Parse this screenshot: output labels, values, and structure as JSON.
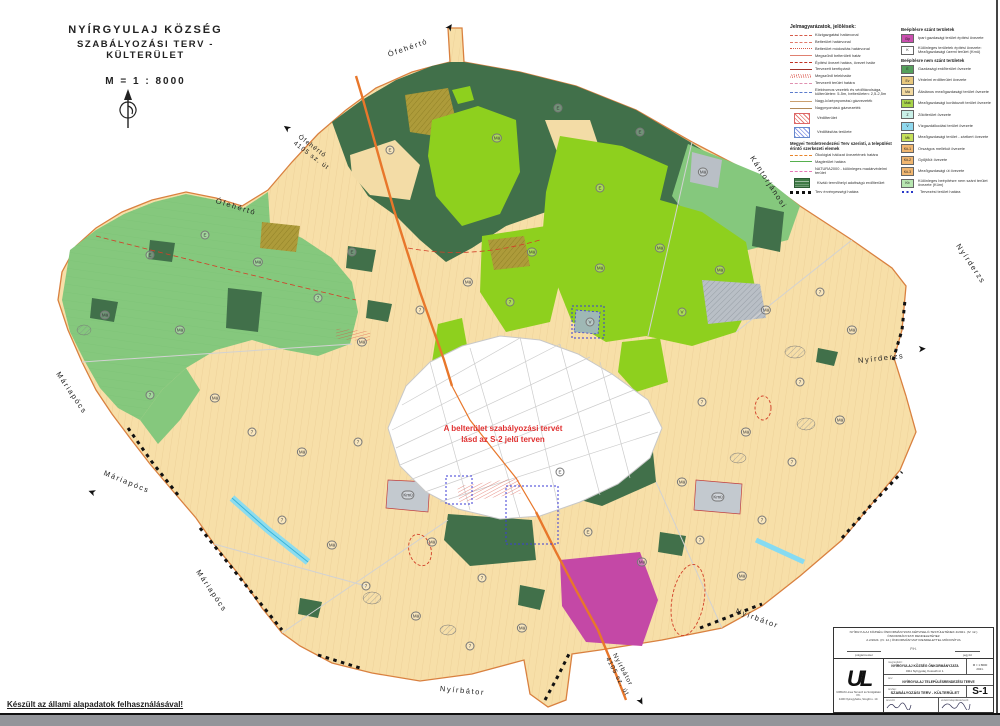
{
  "page": {
    "title_line1": "NYÍRGYULAJ KÖZSÉG",
    "title_line2": "SZABÁLYOZÁSI TERV - KÜLTERÜLET",
    "scale": "M = 1 : 8000",
    "footnote": "Készült az állami alapadatok felhasználásával!"
  },
  "map": {
    "annotation_line1": "A belterület szabályozási tervét",
    "annotation_line2": "lásd az S-2 jelű terven",
    "edge_labels": {
      "n_ofeherto": "Ófehértó",
      "nw_road_place": "Ófehértó",
      "nw_road_number": "4105 sz. út",
      "w_ofeherto": "Ófehértó",
      "ne_kantorjanosi": "Kántorjánosi",
      "e_nyirderzs_upper": "Nyírderzs",
      "e_nyirderzs_lower": "Nyírderzs",
      "se_nyirbator": "Nyírbátor",
      "s_road_place": "Nyírbátor",
      "s_road_number": "4105 sz. út",
      "s_nyirbator": "Nyírbátor",
      "sw_mariapocs_upper": "Máriapócs",
      "sw_mariapocs_mid": "Máriapócs",
      "sw_mariapocs_lower": "Máriapócs"
    },
    "markers": [
      [
        150,
        255,
        "E"
      ],
      [
        105,
        315,
        "Má"
      ],
      [
        205,
        235,
        "E"
      ],
      [
        258,
        262,
        "Má"
      ],
      [
        318,
        298,
        "7"
      ],
      [
        352,
        252,
        "E"
      ],
      [
        390,
        150,
        "E"
      ],
      [
        497,
        138,
        "Má"
      ],
      [
        558,
        108,
        "E"
      ],
      [
        640,
        132,
        "E"
      ],
      [
        703,
        172,
        "Má"
      ],
      [
        600,
        188,
        "E"
      ],
      [
        532,
        252,
        "Má"
      ],
      [
        600,
        268,
        "Má"
      ],
      [
        660,
        248,
        "Má"
      ],
      [
        720,
        270,
        "Má"
      ],
      [
        766,
        310,
        "Má"
      ],
      [
        820,
        292,
        "7"
      ],
      [
        852,
        330,
        "Má"
      ],
      [
        800,
        382,
        "7"
      ],
      [
        840,
        420,
        "Má"
      ],
      [
        792,
        462,
        "7"
      ],
      [
        746,
        432,
        "Má"
      ],
      [
        702,
        402,
        "7"
      ],
      [
        682,
        312,
        "V"
      ],
      [
        180,
        330,
        "Má"
      ],
      [
        150,
        395,
        "7"
      ],
      [
        215,
        398,
        "Má"
      ],
      [
        252,
        432,
        "7"
      ],
      [
        302,
        452,
        "Má"
      ],
      [
        282,
        520,
        "7"
      ],
      [
        332,
        545,
        "Má"
      ],
      [
        366,
        586,
        "7"
      ],
      [
        416,
        616,
        "Má"
      ],
      [
        470,
        646,
        "7"
      ],
      [
        522,
        628,
        "Má"
      ],
      [
        588,
        532,
        "E"
      ],
      [
        642,
        562,
        "Má"
      ],
      [
        700,
        540,
        "7"
      ],
      [
        742,
        576,
        "Má"
      ],
      [
        762,
        520,
        "7"
      ],
      [
        682,
        482,
        "Má"
      ],
      [
        432,
        542,
        "Má"
      ],
      [
        482,
        578,
        "7"
      ],
      [
        560,
        472,
        "E"
      ],
      [
        358,
        442,
        "7"
      ],
      [
        362,
        342,
        "Má"
      ],
      [
        420,
        310,
        "7"
      ],
      [
        468,
        282,
        "Má"
      ],
      [
        510,
        302,
        "7"
      ],
      [
        408,
        495,
        "Kmü"
      ],
      [
        718,
        497,
        "Kmü"
      ],
      [
        590,
        322,
        "V"
      ]
    ]
  },
  "legend": {
    "title": "Jelmagyarázatok, jelölések:",
    "left_sections": [
      {
        "header": null,
        "items": [
          {
            "sym": "dashdot-red",
            "label": "Közigazgatási határvonal"
          },
          {
            "sym": "dash-red",
            "label": "Belterület határvonal"
          },
          {
            "sym": "dot-red",
            "label": "Belterület módosítás határvonal"
          },
          {
            "sym": "solid-red",
            "label": "Megszűnő belterületi határ"
          },
          {
            "sym": "dashdot2-red",
            "label": "Építési övezet határa, övezet határ"
          },
          {
            "sym": "solid-darkred",
            "label": "Tervezett kerékpárút"
          },
          {
            "sym": "hatch-red",
            "label": "Megszűnő telekhatár"
          },
          {
            "sym": "dash-pink",
            "label": "Tervezett terület határa"
          },
          {
            "sym": "dash-blue",
            "label": "Elektromos vezeték és védőtávolsága, külterületen: 5-5m, belterületen: 2,5-2,5m"
          },
          {
            "sym": "line-gaz",
            "label": "Nagy-középnyomású gázvezeték"
          },
          {
            "sym": "line-gaz2",
            "label": "Nagynyomású gázvezeték"
          },
          {
            "sym": "box-hatch-red",
            "label": "Védőterület"
          },
          {
            "sym": "box-hatch-blue",
            "label": "Védőfásítás területe"
          }
        ]
      },
      {
        "header": "Megyei Területrendezési Terv szerinti, a települést érintő szerkezeti elemek",
        "items": [
          {
            "sym": "dashdot-orange",
            "label": "Ökológiai hálózat övezetének határa"
          },
          {
            "sym": "solid-green",
            "label": "Magterület határa"
          },
          {
            "sym": "dash-pink2",
            "label": "NATURA2000 - különleges madárvédelmi terület"
          },
          {
            "sym": "box-green-e",
            "label": "Kiváló termőhelyi adottságú erdőterület"
          },
          {
            "sym": "squares-black",
            "label": "Terv érvényességi határa"
          }
        ]
      }
    ],
    "right_sections": [
      {
        "header": "Beépítésre szánt területek",
        "items": [
          {
            "code": "Gip",
            "color": "#c94fae",
            "label": "Ipari gazdasági terület építési övezete"
          },
          {
            "code": "K",
            "color": "#ffffff",
            "label": "Különleges területek építési övezete: Mezőgazdasági üzemi terület (Kmü)"
          }
        ]
      },
      {
        "header": "Beépítésre nem szánt területek",
        "items": [
          {
            "code": "E",
            "color": "#55a05c",
            "label": "Gazdasági erdőterület övezete"
          },
          {
            "code": "Ev",
            "color": "#e8c87e",
            "label": "Védelmi erdőterület övezete"
          },
          {
            "code": "Má",
            "color": "#f2d9a0",
            "label": "Általános mezőgazdasági terület övezete"
          },
          {
            "code": "Mák",
            "color": "#a8d44a",
            "label": "Mezőgazdasági korlátozott terület övezete"
          },
          {
            "code": "Z",
            "color": "#c9f0e8",
            "label": "Zöldterület övezete"
          },
          {
            "code": "V",
            "color": "#8fd8ee",
            "label": "Vízgazdálkodási terület övezete"
          },
          {
            "code": "Mk",
            "color": "#c6e05a",
            "label": "Mezőgazdasági terület - zártkert övezete"
          },
          {
            "code": "Kö-1",
            "color": "#f0b670",
            "label": "Országos mellékút övezete"
          },
          {
            "code": "Kö-2",
            "color": "#f0b670",
            "label": "Gyűjtőút övezete"
          },
          {
            "code": "Kö-3",
            "color": "#f0b670",
            "label": "Mezőgazdasági út övezete"
          },
          {
            "code": "Kb",
            "color": "#b7e6b0",
            "label": "Különleges beépítésre nem szánt terület övezete (Küm)"
          },
          {
            "sym": "dots-blue",
            "label": "Tervezési terület határa"
          }
        ]
      }
    ]
  },
  "titleblock": {
    "approval_line1": "NYÍRGYULAJ KÖZSÉG ÖNKORMÁNYZATA KÉPVISELŐ-TESTÜLETÉNEK 4/2021. (IV. 12.) ÖNKORMÁNYZATI RENDELETÉHEZ",
    "approval_line2": "A 2/2024. (IV. 12.) ÖNKORMÁNYZATI RENDELETTEL MÓDOSÍTVA",
    "ph": "P.H.",
    "mayor": "polgármester",
    "notary": "jegyző",
    "logo_text": "UL",
    "company_name": "URBAN Linea Tervező és Szolgáltató Kft.",
    "company_address": "4400 Nyíregyháza, Szegfű u. 10.",
    "client_label": "megrendelő:",
    "client_name": "NYÍRGYULAJ KÖZSÉG ÖNKORMÁNYZATA",
    "client_address": "4311 Nyírgyulaj, Kossuth út 1.",
    "project_label": "terv:",
    "project_title": "NYÍRGYULAJ TELEPÜLÉSRENDEZÉSI TERVE",
    "sheet_label": "tervlap:",
    "sheet_title": "SZABÁLYOZÁSI TERV - KÜLTERÜLET",
    "scale_value": "M = 1:8000",
    "date_value": "2021.",
    "sheet_number": "S-1",
    "sig_label_left": "tervező:",
    "sig_label_right": "vezető településtervező:"
  },
  "colors": {
    "farmland": "#f7dfa8",
    "forest": "#41704a",
    "grassland": "#85c87d",
    "intensive_green": "#8ed01e",
    "orchard_olive": "#ad9b3a",
    "industrial_magenta": "#c448a6",
    "special_gray": "#b9bfc6",
    "water_cyan": "#86dbf2",
    "road_orange": "#e8772b",
    "regulation_red": "#e03030"
  }
}
